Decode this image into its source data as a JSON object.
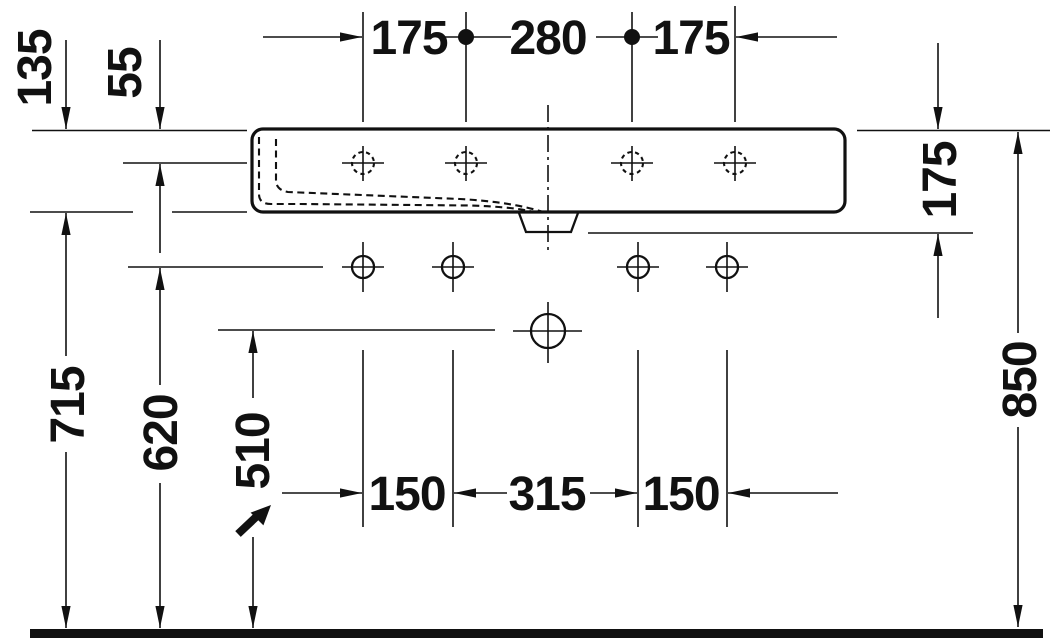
{
  "drawing": {
    "type": "washbasin technical dimension drawing, front elevation",
    "line_color": "#111111",
    "background": "#ffffff"
  },
  "dimensions": {
    "top_chain": [
      "175",
      "280",
      "175"
    ],
    "bottom_chain": [
      "150",
      "315",
      "150"
    ],
    "left_offsets": [
      "135",
      "55"
    ],
    "left_heights": [
      "715",
      "620",
      "510"
    ],
    "right_depth": "175",
    "right_height": "850"
  }
}
